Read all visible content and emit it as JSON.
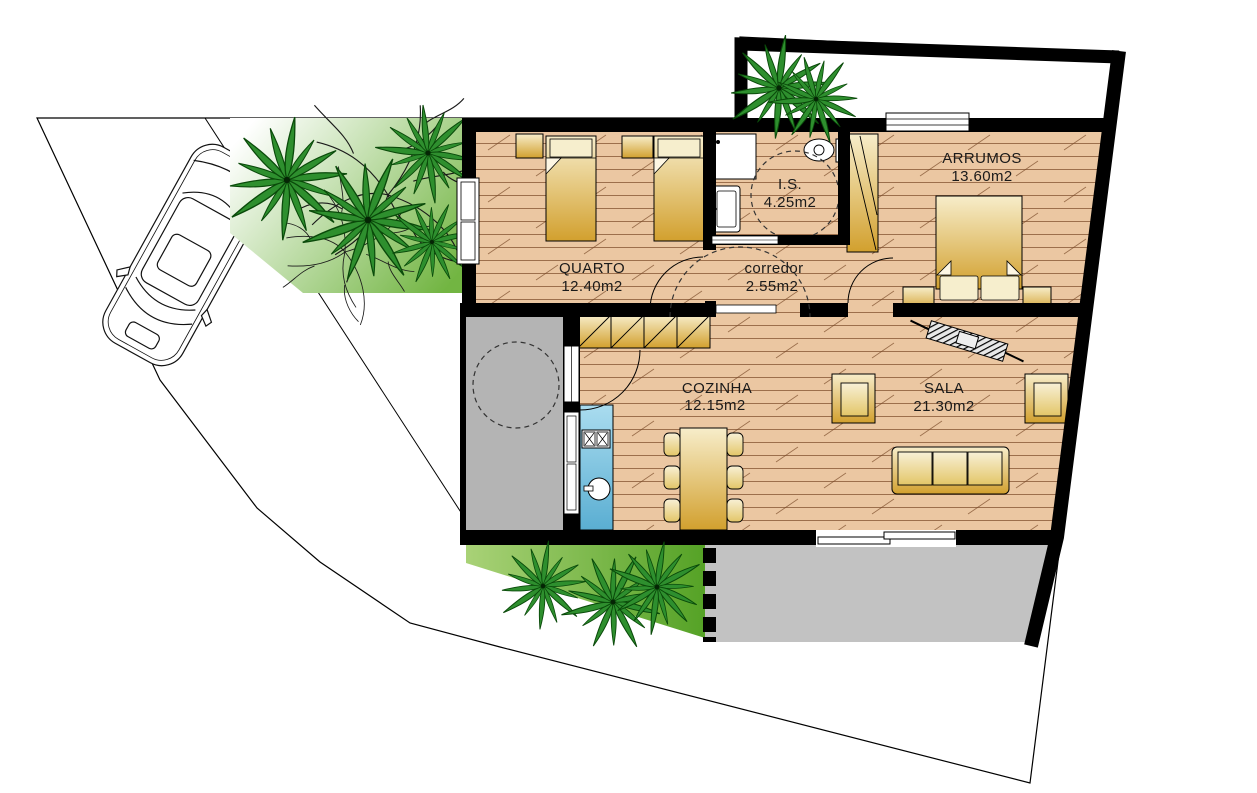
{
  "rooms": [
    {
      "id": "quarto",
      "name": "QUARTO",
      "area": "12.40m2"
    },
    {
      "id": "is",
      "name": "I.S.",
      "area": "4.25m2"
    },
    {
      "id": "corredor",
      "name": "corredor",
      "area": "2.55m2"
    },
    {
      "id": "arrumos",
      "name": "ARRUMOS",
      "area": "13.60m2"
    },
    {
      "id": "cozinha",
      "name": "COZINHA",
      "area": "12.15m2"
    },
    {
      "id": "sala",
      "name": "SALA",
      "area": "21.30m2"
    }
  ],
  "colors": {
    "wall": "#000000",
    "floor_wood": "#ebc7a2",
    "floor_line": "#7a4a28",
    "furniture_gold_light": "#f7edca",
    "furniture_gold_dark": "#d2a02e",
    "pillow": "#f6eecd",
    "counter_blue_light": "#aadcef",
    "counter_blue_dark": "#5aaed2",
    "lawn_green": "#72b542",
    "lawn_green_dark": "#55a226",
    "palm_green": "#2e8f2e",
    "patio_gray": "#b4b4b4",
    "terrace_gray": "#c2c2c2"
  },
  "elements": {
    "icons": [
      "car-top-view",
      "palm-tree",
      "deciduous-tree",
      "single-bed",
      "double-bed",
      "wardrobe",
      "sofa",
      "armchair",
      "dining-table",
      "chair",
      "kitchen-cabinets",
      "kitchen-counter",
      "stove",
      "sink",
      "toilet",
      "shower",
      "washbasin",
      "door-swing-arc",
      "sliding-door",
      "window",
      "turning-circle"
    ]
  }
}
